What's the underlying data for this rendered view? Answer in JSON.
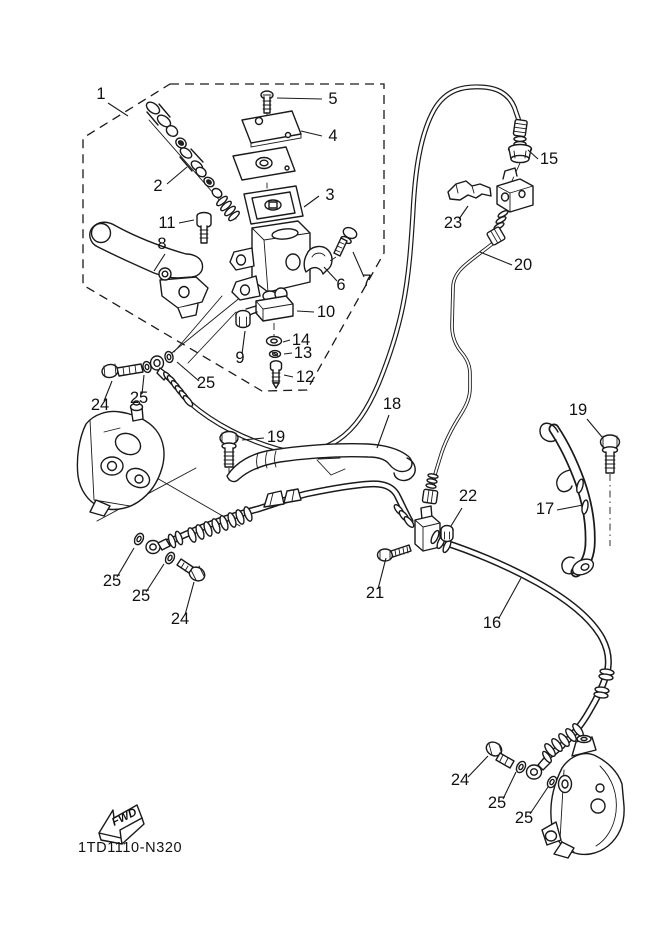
{
  "drawing": {
    "part_code": "1TD1110-N320",
    "fwd_label": "FWD",
    "background": "#ffffff",
    "line_color": "#1a1a1a"
  },
  "callouts": [
    {
      "part": "1",
      "label": "1",
      "x": 101,
      "y": 99,
      "leader": [
        108,
        103,
        128,
        116
      ]
    },
    {
      "part": "2",
      "label": "2",
      "x": 158,
      "y": 191,
      "leader": [
        167,
        184,
        187,
        167
      ]
    },
    {
      "part": "3",
      "label": "3",
      "x": 330,
      "y": 200,
      "leader": [
        319,
        196,
        304,
        207
      ]
    },
    {
      "part": "4",
      "label": "4",
      "x": 333,
      "y": 141,
      "leader": [
        322,
        136,
        301,
        131
      ]
    },
    {
      "part": "5",
      "label": "5",
      "x": 333,
      "y": 104,
      "leader": [
        322,
        99,
        277,
        98
      ]
    },
    {
      "part": "6",
      "label": "6",
      "x": 341,
      "y": 290,
      "leader": [
        337,
        281,
        324,
        267
      ]
    },
    {
      "part": "7",
      "label": "7",
      "x": 367,
      "y": 286,
      "leader": [
        364,
        277,
        353,
        252
      ]
    },
    {
      "part": "8",
      "label": "8",
      "x": 162,
      "y": 249,
      "leader": [
        165,
        254,
        154,
        271
      ]
    },
    {
      "part": "9",
      "label": "9",
      "x": 240,
      "y": 363,
      "leader": [
        242,
        354,
        245,
        331
      ]
    },
    {
      "part": "10",
      "label": "10",
      "x": 326,
      "y": 317,
      "leader": [
        314,
        312,
        297,
        311
      ]
    },
    {
      "part": "11",
      "label": "11",
      "x": 167,
      "y": 228,
      "leader": [
        179,
        223,
        194,
        220
      ]
    },
    {
      "part": "12",
      "label": "12",
      "x": 305,
      "y": 382,
      "leader": [
        293,
        377,
        284,
        375
      ]
    },
    {
      "part": "13",
      "label": "13",
      "x": 303,
      "y": 358,
      "leader": [
        292,
        353,
        284,
        354
      ]
    },
    {
      "part": "14",
      "label": "14",
      "x": 301,
      "y": 345,
      "leader": [
        290,
        340,
        283,
        342
      ]
    },
    {
      "part": "15",
      "label": "15",
      "x": 549,
      "y": 164,
      "leader": [
        538,
        159,
        528,
        150
      ]
    },
    {
      "part": "16",
      "label": "16",
      "x": 492,
      "y": 628,
      "leader": [
        499,
        618,
        521,
        578
      ]
    },
    {
      "part": "17",
      "label": "17",
      "x": 545,
      "y": 514,
      "leader": [
        557,
        510,
        583,
        505
      ]
    },
    {
      "part": "18",
      "label": "18",
      "x": 392,
      "y": 409,
      "leader": [
        389,
        415,
        377,
        448
      ]
    },
    {
      "part": "19-left",
      "label": "19",
      "x": 276,
      "y": 442,
      "leader": [
        264,
        438,
        242,
        440
      ]
    },
    {
      "part": "19-right",
      "label": "19",
      "x": 578,
      "y": 415,
      "leader": [
        587,
        419,
        602,
        437
      ]
    },
    {
      "part": "20",
      "label": "20",
      "x": 523,
      "y": 270,
      "leader": [
        512,
        265,
        480,
        252
      ]
    },
    {
      "part": "21",
      "label": "21",
      "x": 375,
      "y": 598,
      "leader": [
        378,
        589,
        386,
        558
      ]
    },
    {
      "part": "22",
      "label": "22",
      "x": 468,
      "y": 501,
      "leader": [
        462,
        508,
        451,
        526
      ]
    },
    {
      "part": "23",
      "label": "23",
      "x": 453,
      "y": 228,
      "leader": [
        459,
        219,
        468,
        206
      ]
    },
    {
      "part": "24-master",
      "label": "24",
      "x": 100,
      "y": 410,
      "leader": [
        104,
        401,
        112,
        381
      ]
    },
    {
      "part": "25-master-1",
      "label": "25",
      "x": 139,
      "y": 403,
      "leader": [
        142,
        394,
        144,
        375
      ]
    },
    {
      "part": "25-master-2",
      "label": "25",
      "x": 206,
      "y": 388,
      "leader": [
        199,
        381,
        177,
        362
      ]
    },
    {
      "part": "24-left",
      "label": "24",
      "x": 180,
      "y": 624,
      "leader": [
        185,
        615,
        194,
        582
      ]
    },
    {
      "part": "25-left-1",
      "label": "25",
      "x": 112,
      "y": 586,
      "leader": [
        117,
        577,
        134,
        548
      ]
    },
    {
      "part": "25-left-2",
      "label": "25",
      "x": 141,
      "y": 601,
      "leader": [
        146,
        592,
        164,
        564
      ]
    },
    {
      "part": "24-right",
      "label": "24",
      "x": 460,
      "y": 785,
      "leader": [
        468,
        777,
        488,
        756
      ]
    },
    {
      "part": "25-right-1",
      "label": "25",
      "x": 497,
      "y": 808,
      "leader": [
        503,
        799,
        516,
        772
      ]
    },
    {
      "part": "25-right-2",
      "label": "25",
      "x": 524,
      "y": 823,
      "leader": [
        530,
        814,
        548,
        787
      ]
    }
  ]
}
